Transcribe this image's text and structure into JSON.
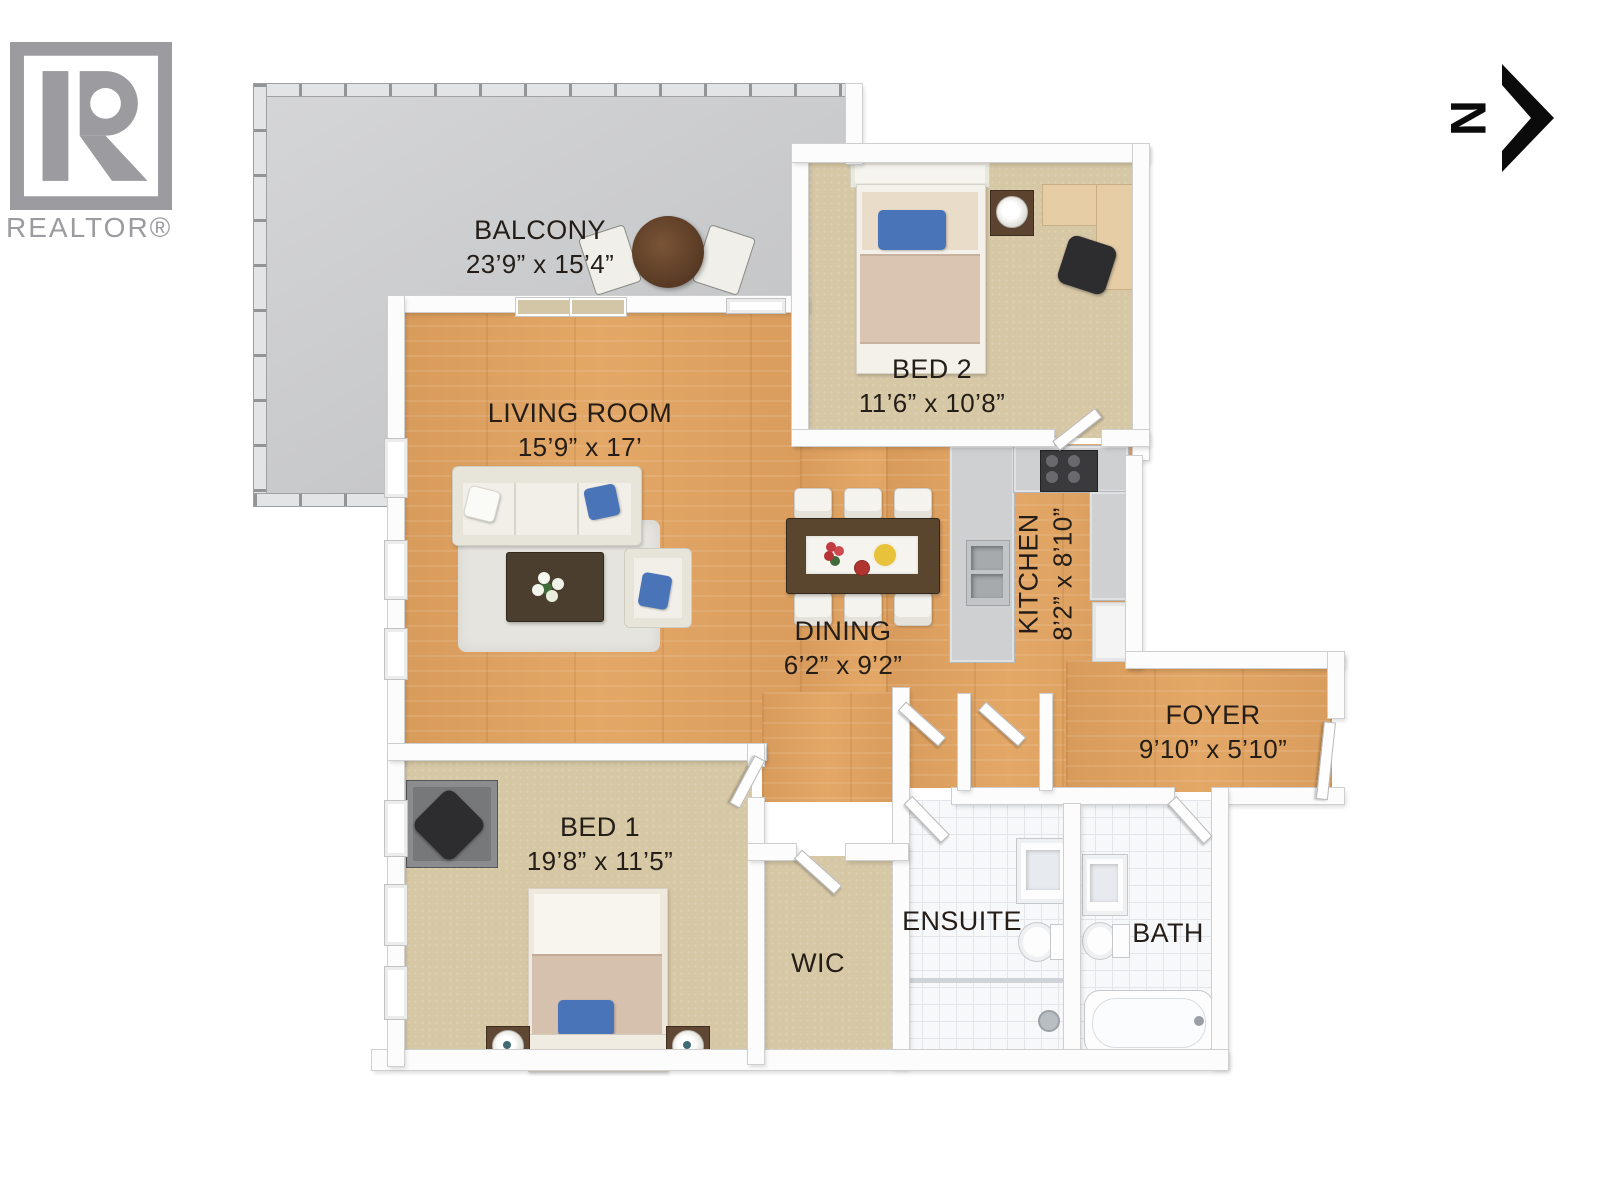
{
  "branding": {
    "logo_text": "REALTOR®"
  },
  "compass": {
    "north": "N"
  },
  "rooms": {
    "balcony": {
      "name": "BALCONY",
      "dims": "23’9” x 15’4”"
    },
    "living": {
      "name": "LIVING ROOM",
      "dims": "15’9” x 17’"
    },
    "bed2": {
      "name": "BED 2",
      "dims": "11’6” x 10’8”"
    },
    "kitchen": {
      "name": "KITCHEN",
      "dims": "8’2” x 8’10”"
    },
    "dining": {
      "name": "DINING",
      "dims": "6’2” x 9’2”"
    },
    "foyer": {
      "name": "FOYER",
      "dims": "9’10” x 5’10”"
    },
    "bed1": {
      "name": "BED 1",
      "dims": "19’8” x 11’5”"
    },
    "wic": {
      "name": "WIC"
    },
    "ensuite": {
      "name": "ENSUITE"
    },
    "bath": {
      "name": "BATH"
    }
  },
  "colors": {
    "wood_floor": "#dfa262",
    "carpet": "#d6c7a5",
    "balcony_floor": "#c9cacc",
    "bath_tile": "#f7f8fa",
    "wall": "#fcfcfc",
    "accent_pillow_blue": "#4a74b8",
    "logo_gray": "#9b9ba0",
    "label_text": "#241d18"
  }
}
